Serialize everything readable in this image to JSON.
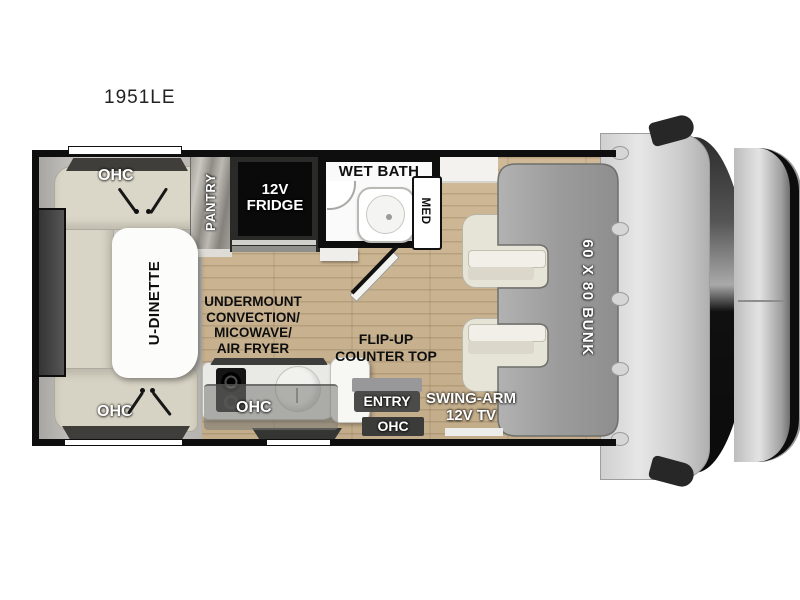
{
  "title": "1951LE",
  "labels": {
    "dinette": "U-DINETTE",
    "dinette_ohc_top": "OHC",
    "dinette_ohc_bottom": "OHC",
    "pantry": "PANTRY",
    "fridge_lines": [
      "12V",
      "FRIDGE"
    ],
    "wet_bath": "WET BATH",
    "med": "MED",
    "undermount_lines": [
      "UNDERMOUNT",
      "CONVECTION/",
      "MICOWAVE/",
      "AIR FRYER"
    ],
    "flip_up_lines": [
      "FLIP-UP",
      "COUNTER TOP"
    ],
    "kitchen_ohc": "OHC",
    "entry": "ENTRY",
    "entry_ohc": "OHC",
    "tv_lines": [
      "SWING-ARM",
      "12V TV"
    ],
    "bunk": "60 X 80 BUNK"
  },
  "colors": {
    "wall": "#0e0e0e",
    "floor_wood": "#c9b392",
    "bunk_gray": "#9c9c9c",
    "sofa_beige": "#d9d5c6",
    "table_white": "#fcfcfa",
    "counter_gray": "#e9e9e6",
    "fridge_black": "#0a0a0a",
    "cab_gray": "#d9d9d9",
    "dark_bar": "#4b4b49",
    "window_dark": "#3f3f3f"
  }
}
